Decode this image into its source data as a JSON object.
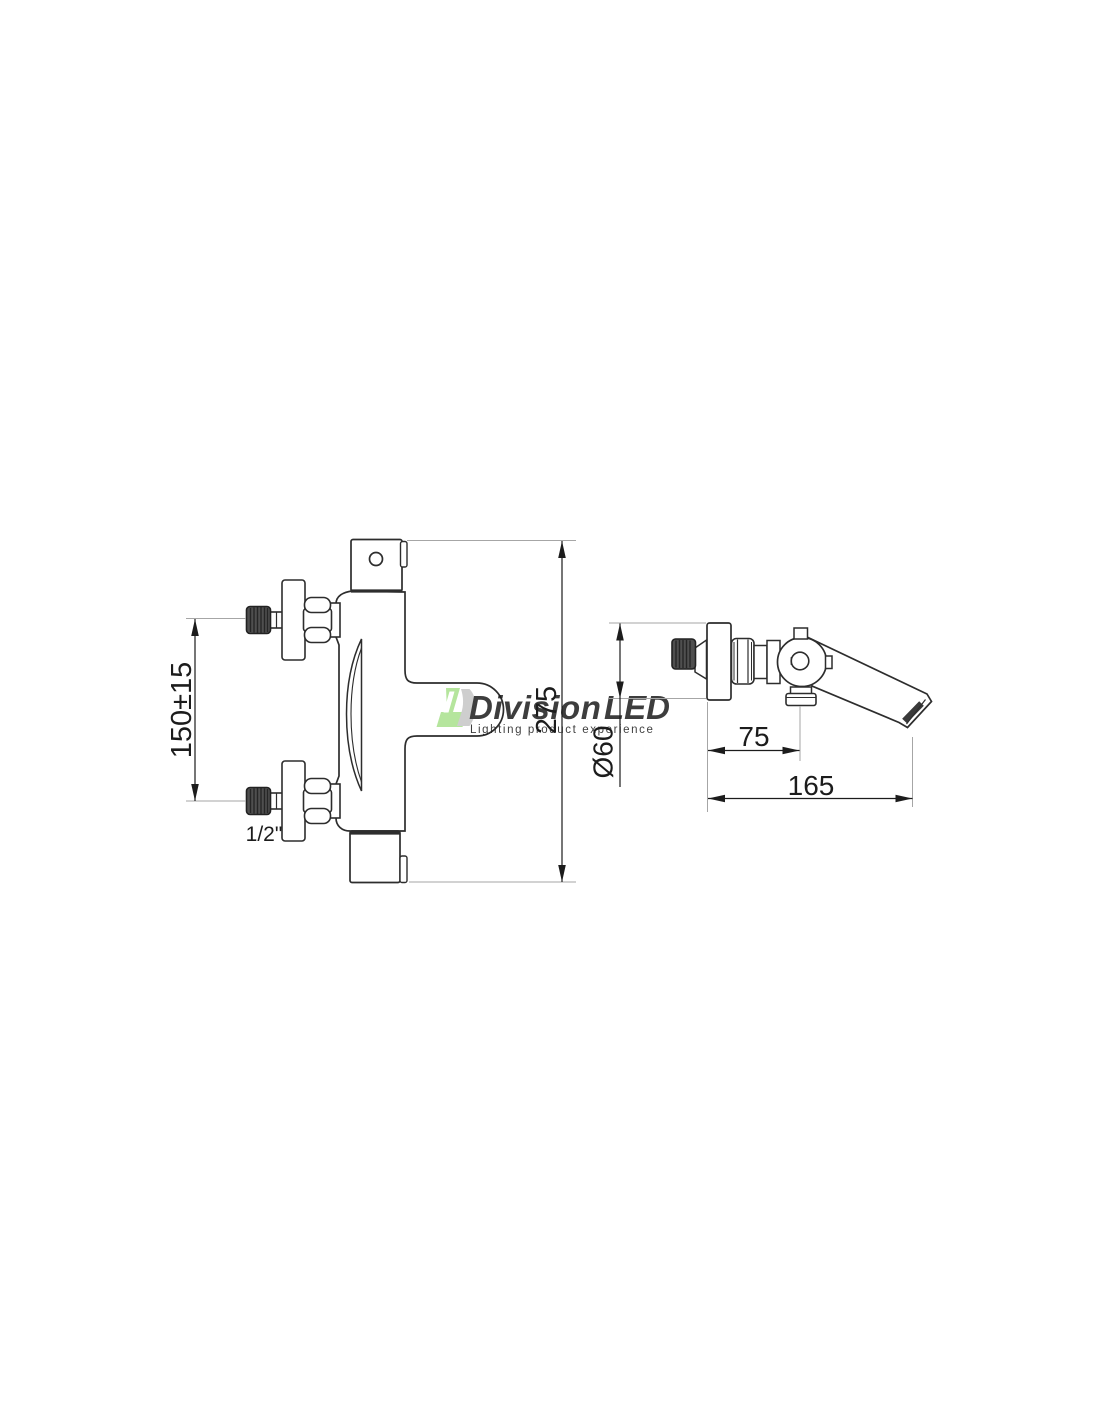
{
  "page": {
    "background_color": "#ffffff"
  },
  "drawing": {
    "type": "technical-dimension-drawing",
    "subject": "wall-mounted thermostatic bath shower mixer tap, front and side orthographic views",
    "front_view": {
      "overall_height_label": "275",
      "inlet_spacing_label": "150±15",
      "connection_size_label": "1/2\""
    },
    "side_view": {
      "escutcheon_diameter_label": "Ø60",
      "diverter_offset_label": "75",
      "spout_reach_label": "165"
    },
    "line_color": "#2d2d2d",
    "dimension_color": "#1c1c1c",
    "extension_line_color": "#a6a6a6",
    "knob_fill_color": "#4f4f4f"
  },
  "watermark": {
    "brand_name_gray": "Division",
    "brand_name_green": "LED",
    "tagline": "Lighting product experience",
    "green_color": "#a9e18c",
    "gray_color": "#cccccc",
    "tagline_color": "#d6d6d6"
  }
}
